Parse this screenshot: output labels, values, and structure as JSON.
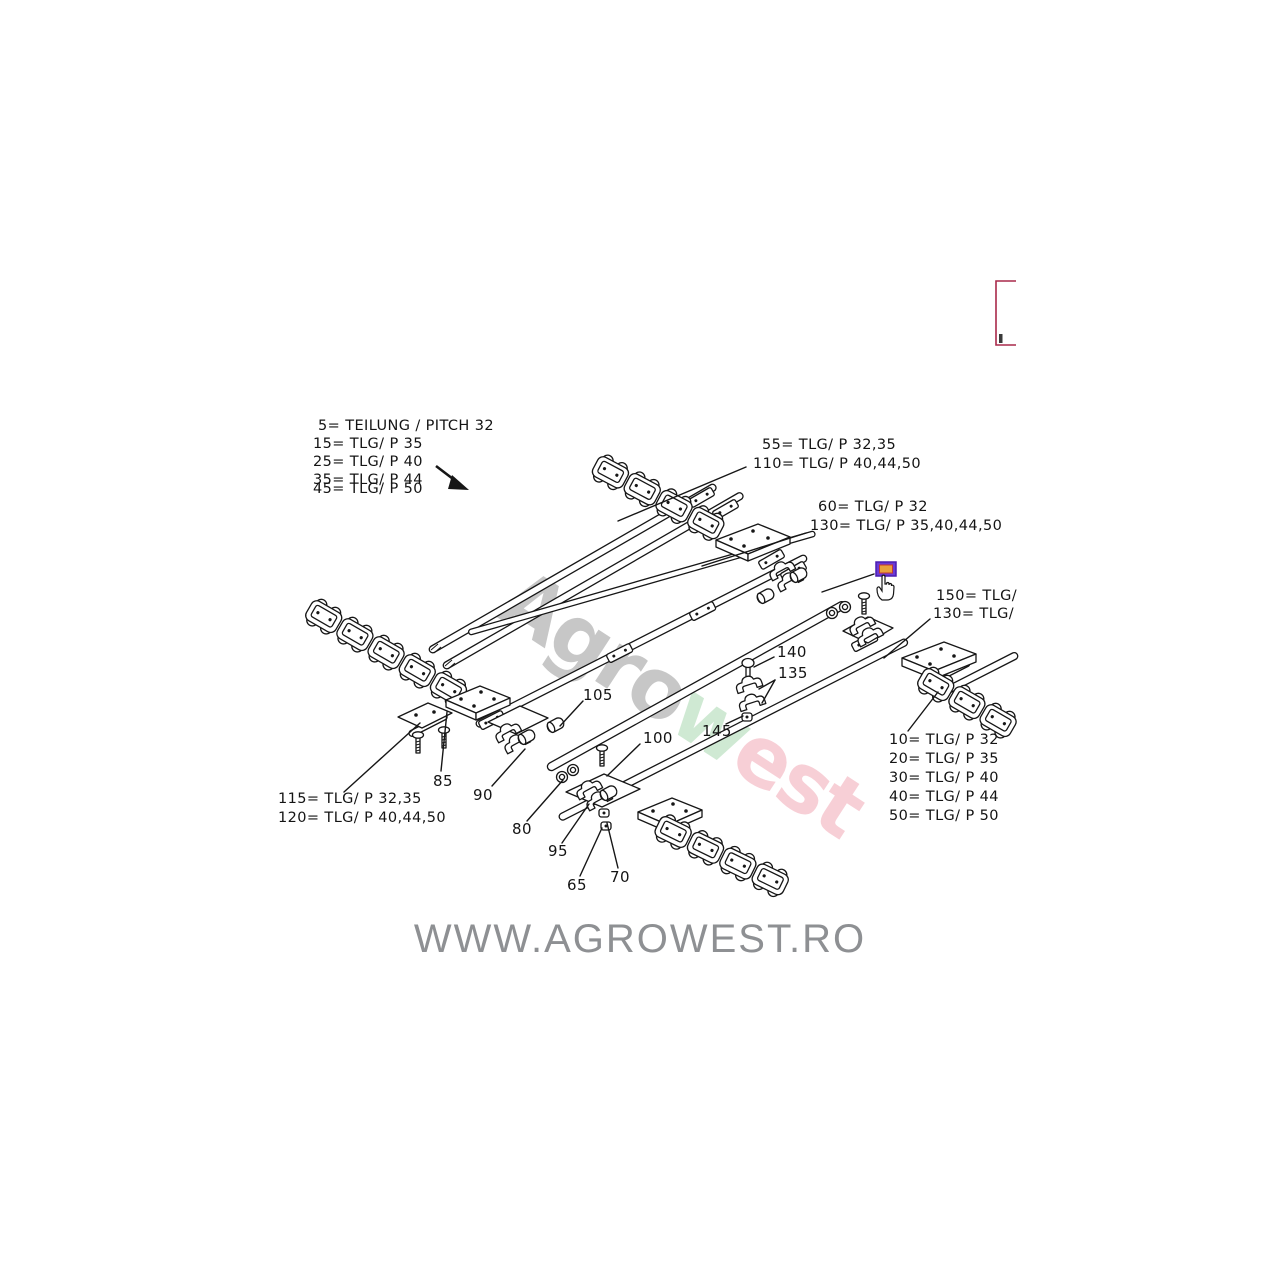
{
  "legend_top_left": {
    "lines": [
      " 5= TEILUNG / PITCH 32",
      "15= TLG/ P 35",
      "25= TLG/ P 40",
      "35= TLG/ P 44",
      "45= TLG/ P 50"
    ]
  },
  "legend_bottom_right": {
    "lines": [
      "10= TLG/ P 32",
      "20= TLG/ P 35",
      "30= TLG/ P 40",
      "40= TLG/ P 44",
      "50= TLG/ P 50"
    ]
  },
  "callouts": {
    "c55": "55= TLG/ P 32,35",
    "c110": "110= TLG/ P 40,44,50",
    "c60": "60= TLG/ P 32",
    "c130a": "130= TLG/ P 35,40,44,50",
    "c150": "150= TLG/",
    "c130b": "130= TLG/",
    "c115": "115= TLG/ P 32,35",
    "c120": "120= TLG/ P 40,44,50"
  },
  "part_numbers": {
    "p65": "65",
    "p70": "70",
    "p80": "80",
    "p85": "85",
    "p90": "90",
    "p95": "95",
    "p100": "100",
    "p105": "105",
    "p135": "135",
    "p140": "140",
    "p145": "145"
  },
  "watermark": {
    "seg1": "Agro",
    "seg2": "w",
    "seg3": "est"
  },
  "footer": {
    "website": "WWW.AGROWEST.RO"
  },
  "colors": {
    "ink": "#161616",
    "watermark_gray": "#9b9b9b",
    "watermark_green": "#a8d8b0",
    "watermark_pink": "#f2a8b6",
    "footer_gray": "#8e9093",
    "hotspot_purple": "#6a3ad6",
    "hotspot_orange": "#e8a23c",
    "corner_box_red": "#a92а45"
  }
}
